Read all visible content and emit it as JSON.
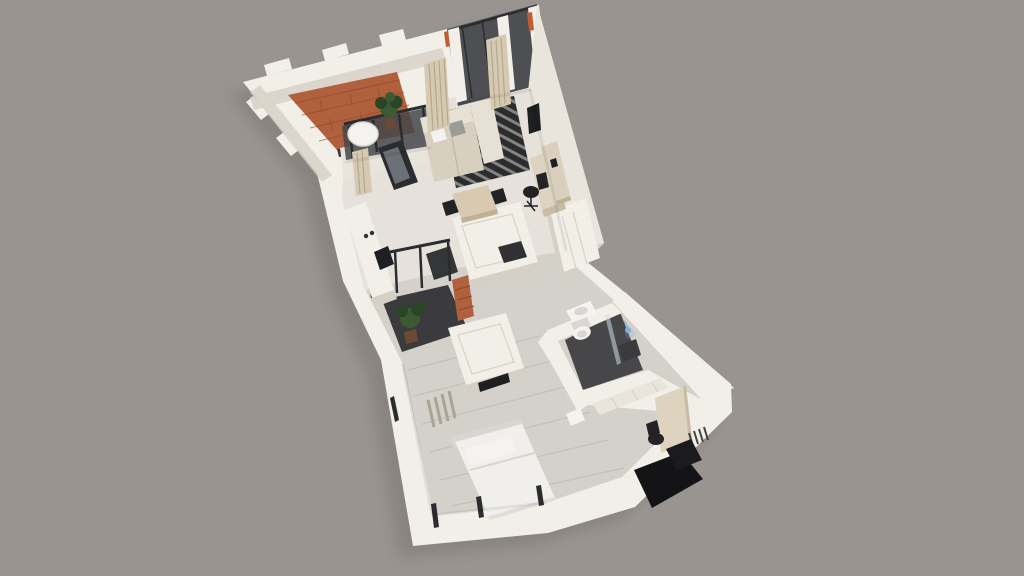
{
  "colors": {
    "background": "#9a9490",
    "shadow": "#6e6a66",
    "wall_top": "#f2eee8",
    "wall_face_light": "#e9e4dc",
    "wall_face_shade": "#d6cfc5",
    "floor_main": "#e6e2db",
    "floor_wood": "#d4d1cb",
    "plank_line": "#c2bfb9",
    "floor_dark": "#47474a",
    "floor_loggia": "#3b3b3e",
    "interior_dark": "#313134",
    "brick": "#b0603d",
    "brick_line": "#8a4a2e",
    "threshold": "#39393c",
    "glass_frame": "#2b2c2f",
    "glass_pane": "#43464b",
    "glass_light": "#ccdae2",
    "curtain": "#d5c9b1",
    "curtain_line": "#b5a88d",
    "sofa_light": "#e7e0d4",
    "sofa_mid": "#d7cfc0",
    "sofa_shadow": "#bfb6a5",
    "pillow_gray": "#9d9b96",
    "rug_dark": "#2c2c2e",
    "rug_light": "#dedcd7",
    "table_wood": "#d8cab0",
    "table_wood_shade": "#bfb194",
    "chair_dark": "#232325",
    "desk_wood": "#d9cfbc",
    "cabinet_beige": "#ddd3bf",
    "cabinet_beige_shade": "#c8bca4",
    "tv_dark": "#1e1f22",
    "bed_white": "#f1efec",
    "bed_shade": "#d9d6d1",
    "fixture": "#f5f3ef",
    "fixture_shade": "#d9d7d3",
    "shower_blue": "#7fb2d6",
    "plant_green": "#3c5a32",
    "plant_dark": "#2a4426",
    "pot": "#6b4a33",
    "radiator": "#aba394",
    "radiator_dark": "#45433f",
    "door_black": "#1b1b1d",
    "landing_black": "#141416",
    "accent_orange": "#c25d33"
  }
}
